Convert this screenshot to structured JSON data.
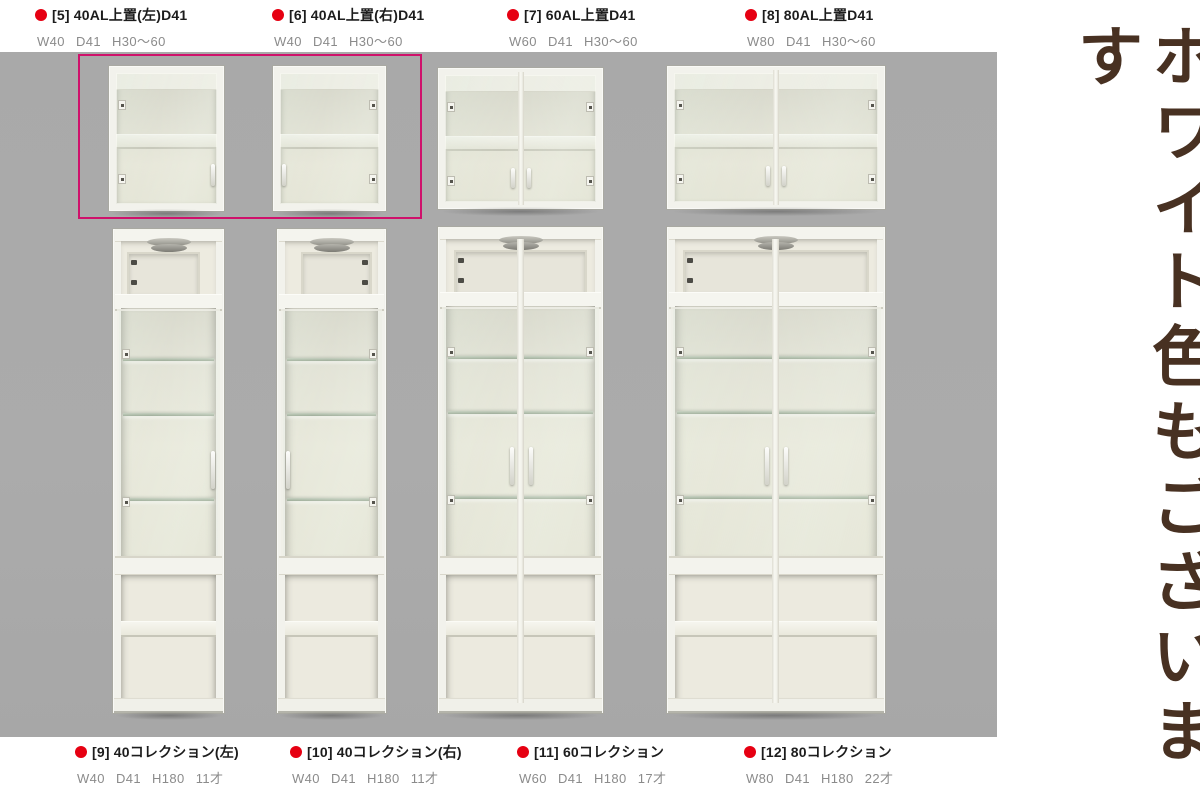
{
  "colors": {
    "photo_bg": "#a9a9a9",
    "highlight": "#cf116b",
    "bullet": "#e60012",
    "name_text": "#1c1c1c",
    "dims_text": "#8b8b8b",
    "banner_text": "#483122",
    "cabinet_white": "#f2f2ec"
  },
  "products_top": [
    {
      "num": "[5]",
      "name": "40AL上置(左)D41",
      "dims": "W40 D41 H30～60"
    },
    {
      "num": "[6]",
      "name": "40AL上置(右)D41",
      "dims": "W40 D41 H30～60"
    },
    {
      "num": "[7]",
      "name": "60AL上置D41",
      "dims": "W60 D41 H30～60"
    },
    {
      "num": "[8]",
      "name": "80AL上置D41",
      "dims": "W80 D41 H30～60"
    }
  ],
  "products_bottom": [
    {
      "num": "[9]",
      "name": "40コレクション(左)",
      "dims": "W40 D41 H180 11才"
    },
    {
      "num": "[10]",
      "name": "40コレクション(右)",
      "dims": "W40 D41 H180 11才"
    },
    {
      "num": "[11]",
      "name": "60コレクション",
      "dims": "W60 D41 H180 17才"
    },
    {
      "num": "[12]",
      "name": "80コレクション",
      "dims": "W80 D41 H180 22才"
    }
  ],
  "side_banner": {
    "text": "ホワイト色もございます"
  },
  "photo": {
    "cabinets": [
      {
        "ref": "5",
        "style": "upper",
        "hinge": "left"
      },
      {
        "ref": "6",
        "style": "upper",
        "hinge": "right"
      },
      {
        "ref": "7",
        "style": "upper",
        "hinge": "double"
      },
      {
        "ref": "8",
        "style": "upper",
        "hinge": "double"
      },
      {
        "ref": "9",
        "style": "tall",
        "hinge": "left"
      },
      {
        "ref": "10",
        "style": "tall",
        "hinge": "right"
      },
      {
        "ref": "11",
        "style": "tall",
        "hinge": "double"
      },
      {
        "ref": "12",
        "style": "tall",
        "hinge": "double"
      }
    ]
  }
}
